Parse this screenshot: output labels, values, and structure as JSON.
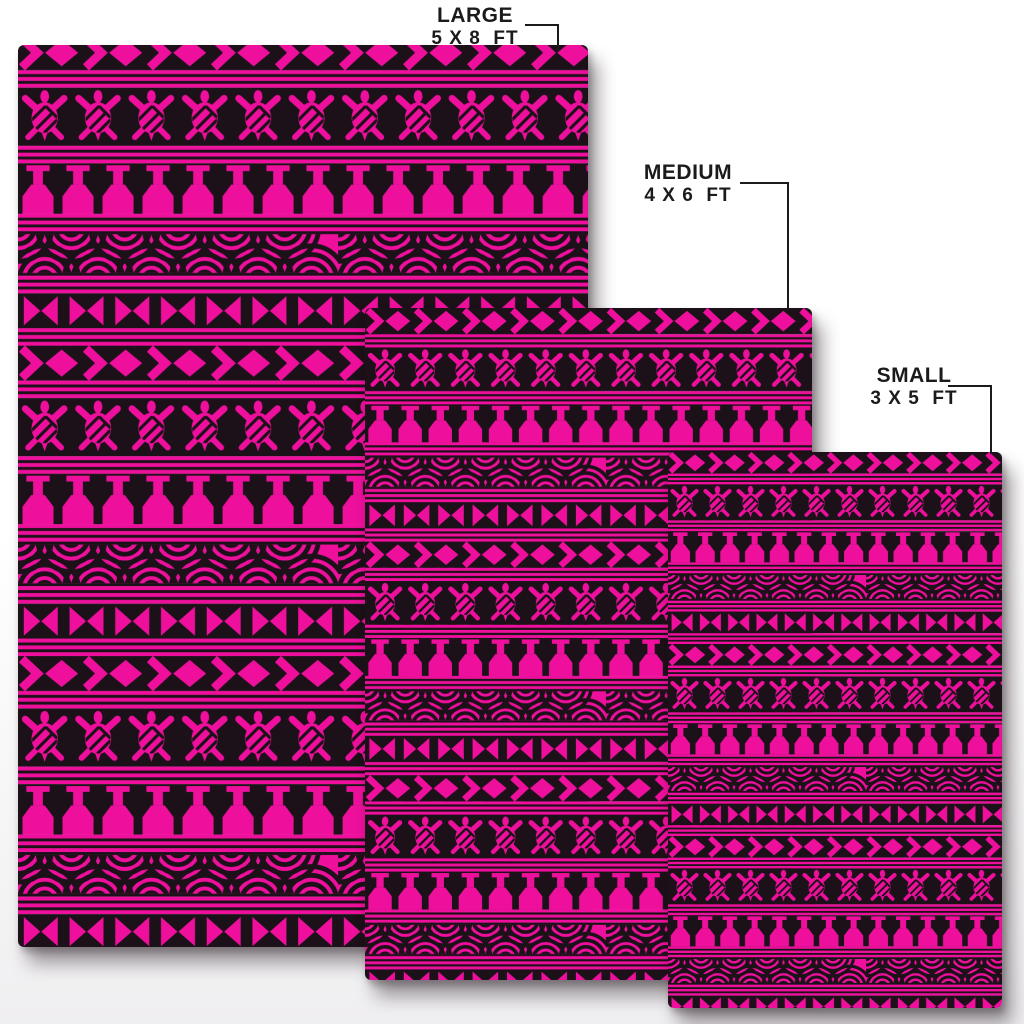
{
  "labels": {
    "large": {
      "title": "LARGE",
      "dimensions": "5 X 8  FT"
    },
    "medium": {
      "title": "MEDIUM",
      "dimensions": "4 X 6  FT"
    },
    "small": {
      "title": "SMALL",
      "dimensions": "3 X 5  FT"
    }
  },
  "colors": {
    "pattern_pink": "#EE109C",
    "pattern_black": "#1C1118",
    "page_background": "#FFFFFF",
    "label_text": "#1B1B1B"
  },
  "pattern": {
    "theme": "polynesian-tribal-turtle",
    "motifs": [
      "chevron-diamond-band",
      "sea-turtle-band",
      "goblet-tiki-band",
      "woven-arc-band",
      "bowtie-band",
      "double-pinstripe"
    ]
  }
}
